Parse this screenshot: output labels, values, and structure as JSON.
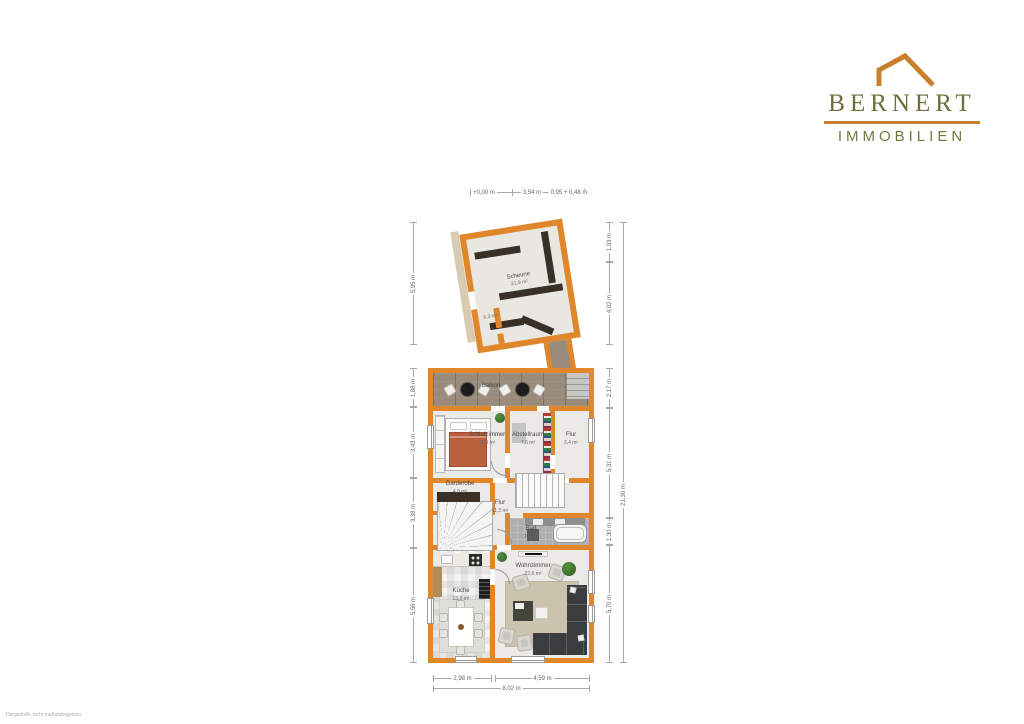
{
  "logo": {
    "name": "BERNERT",
    "subtitle": "IMMOBILIEN"
  },
  "watermark": "Dargestellt, nicht maßstabsgetreu",
  "rooms": {
    "scheune": {
      "name": "Scheune",
      "area": "21,9 m²"
    },
    "annex_small": {
      "area": "6,3 m²"
    },
    "balkon": {
      "name": "Balkon",
      "area": "11,9 m²"
    },
    "schlafzimmer": {
      "name": "Schlafzimmer",
      "area": "11,8 m²"
    },
    "abstellraum": {
      "name": "Abstellraum",
      "area": "7,6 m²"
    },
    "flur_klein": {
      "name": "Flur",
      "area": "3,4 m²"
    },
    "garderobe": {
      "name": "Garderobe",
      "area": "4,0 m²"
    },
    "flur": {
      "name": "Flur",
      "area": "11,3 m²"
    },
    "bad": {
      "name": "Bad",
      "area": "7,9 m²"
    },
    "kueche": {
      "name": "Küche",
      "area": "13,6 m²"
    },
    "wohnzimmer": {
      "name": "Wohnzimmer",
      "area": "22,6 m²"
    }
  },
  "dimensions": {
    "top": {
      "left": "+0,00 m",
      "mid": "3,54 m",
      "right": "0,95 + 0,48 m"
    },
    "left": {
      "annex": "5,95 m",
      "s1": "1,88 m",
      "s2": "3,43 m",
      "s3": "3,38 m",
      "s4": "5,56 m"
    },
    "right": {
      "a1": "1,93 m",
      "a2": "4,02 m",
      "s1": "2,17 m",
      "s2": "5,31 m",
      "s3": "1,30 m",
      "s4": "5,70 m",
      "total": "21,30 m"
    },
    "bottom": {
      "b1": "2,98 m",
      "b2": "4,59 m",
      "total": "8,02 m"
    }
  },
  "colors": {
    "wall": "#E0872B",
    "accent": "#C8802C",
    "logo_text": "#6E6F3B"
  }
}
